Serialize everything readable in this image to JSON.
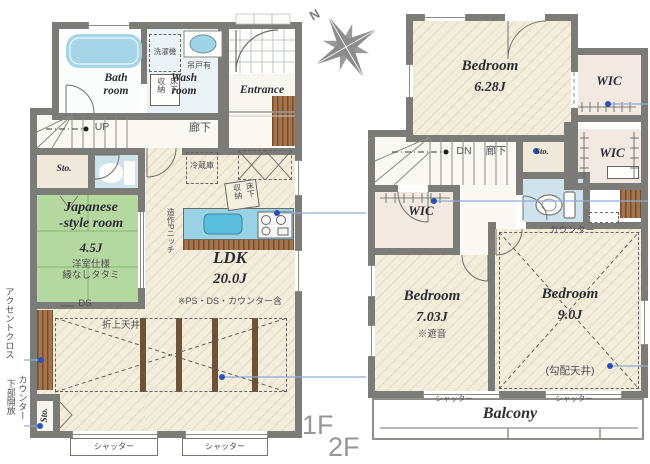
{
  "floor_plan": {
    "f1": {
      "floor_label": "1F",
      "bath_room": "Bath\nroom",
      "wash_room": "Wash\nroom",
      "washer": "洗濯機",
      "hanging_cupboard": "吊戸有",
      "underfloor_storage_wash": "床下\n収納",
      "underfloor_storage_kitchen": "床下\n収納",
      "entrance": "Entrance",
      "corridor": "廊下",
      "up": "UP",
      "storage1": "Sto.",
      "japanese_room_name": "Japanese\n-style room",
      "japanese_room_size": "4.5J",
      "japanese_room_note": "洋室仕様\n縁なしタタミ",
      "ds": "DS",
      "fridge": "冷蔵庫",
      "p_niche": "造作Pニッチ",
      "ldk_name": "LDK",
      "ldk_size": "20.0J",
      "ldk_note": "※PS・DS・カウンター含",
      "raised_ceiling": "折上天井",
      "accent_cloth": "アクセントクロス",
      "counter_open_below": "カウンター\n下部開放",
      "storage2": "Sto.",
      "shutter_left": "シャッター",
      "shutter_right": "シャッター"
    },
    "f2": {
      "floor_label": "2F",
      "compass_north": "N",
      "bedroom1_name": "Bedroom",
      "bedroom1_size": "6.28J",
      "wic1": "WIC",
      "wic2": "WIC",
      "wic3": "WIC",
      "dn": "DN",
      "corridor": "廊下",
      "storage": "Sto.",
      "counter": "カウンター",
      "bedroom2_name": "Bedroom",
      "bedroom2_size": "7.03J",
      "bedroom2_note": "※遮音",
      "bedroom3_name": "Bedroom",
      "bedroom3_size": "9.0J",
      "bedroom3_note": "(勾配天井)",
      "shutter_left": "シャッター",
      "shutter_right": "シャッター",
      "balcony": "Balcony"
    }
  }
}
